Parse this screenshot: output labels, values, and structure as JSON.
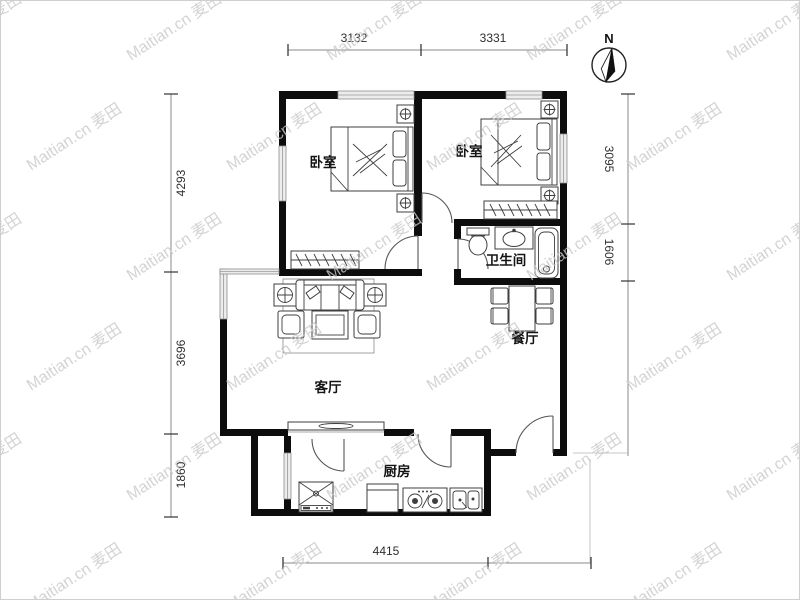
{
  "watermark": {
    "brand": "Maitian.cn",
    "cjk": "麦田"
  },
  "compass": {
    "label": "N"
  },
  "rooms": {
    "bedroom1": "卧室",
    "bedroom2": "卧室",
    "bathroom": "卫生间",
    "dining": "餐厅",
    "living": "客厅",
    "kitchen": "厨房"
  },
  "dims": {
    "top": [
      "3132",
      "3331"
    ],
    "left": [
      "4293",
      "3696",
      "1860"
    ],
    "right": [
      "3095",
      "1606"
    ],
    "bottom": [
      "4415"
    ]
  },
  "colors": {
    "wall": "#0d0d0d",
    "window_fill": "#ececec",
    "furniture_stroke": "#3f3f3f",
    "dimension_text": "#2e2e2e",
    "watermark": "#c9c9c9"
  }
}
